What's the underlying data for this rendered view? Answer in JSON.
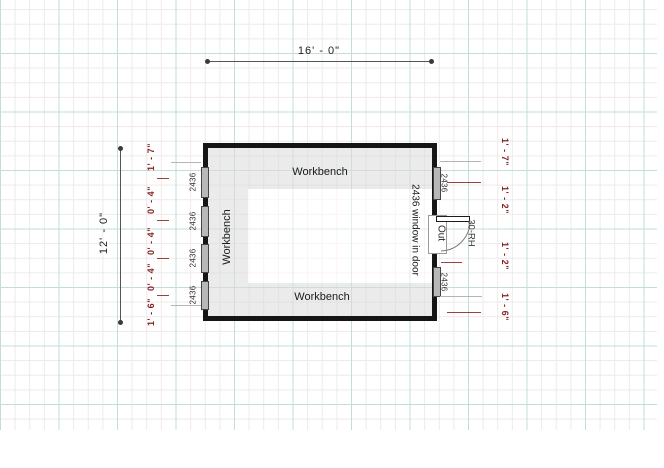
{
  "colors": {
    "dim_red": "#852222",
    "grid_major": "#c3dcdc",
    "grid_minor": "#efe9e9",
    "wall": "#151515"
  },
  "dims": {
    "top": "16' - 0\"",
    "left": "12' - 0\"",
    "left_chain": [
      "1' - 7\"",
      "0' - 4\"",
      "0' - 4\"",
      "0' - 4\"",
      "1' - 6\""
    ],
    "right_chain": [
      "1' - 7\"",
      "1' - 2\"",
      "1' - 2\"",
      "1' - 6\""
    ]
  },
  "room": {
    "benches": {
      "top": "Workbench",
      "left": "Workbench",
      "bottom": "Workbench"
    },
    "windows": {
      "left": [
        "2436",
        "2436",
        "2436",
        "2436"
      ],
      "right": [
        "2436",
        "2436"
      ]
    },
    "door": {
      "note": "2436 window in door",
      "swing": "Out",
      "type": "30-RH"
    }
  }
}
